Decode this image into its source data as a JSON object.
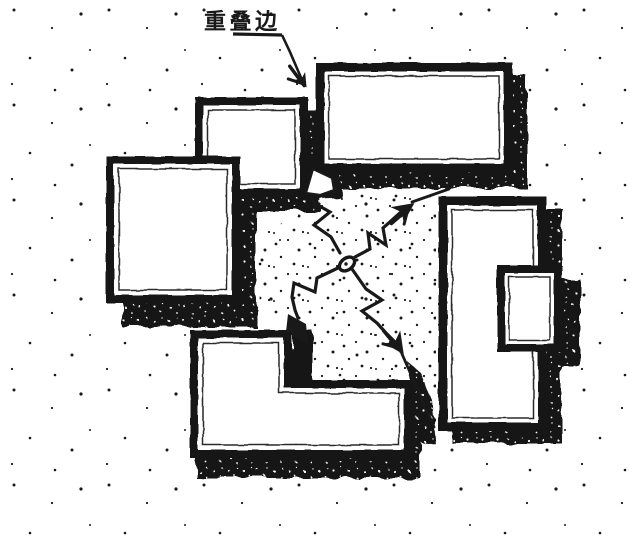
{
  "figure": {
    "type": "architectural-sketch-diagram",
    "label": "重叠边",
    "blocks_count": 6,
    "colors": {
      "ink": "#191919",
      "paper": "#ffffff"
    },
    "symbols": {
      "leader_arrow": "crow-foot-arrow-icon",
      "line_break": "zigzag-break-icon",
      "pivot": "center-pivot-circle-icon",
      "shadow": "cast-shadow",
      "background_texture": "stipple-dots"
    }
  }
}
